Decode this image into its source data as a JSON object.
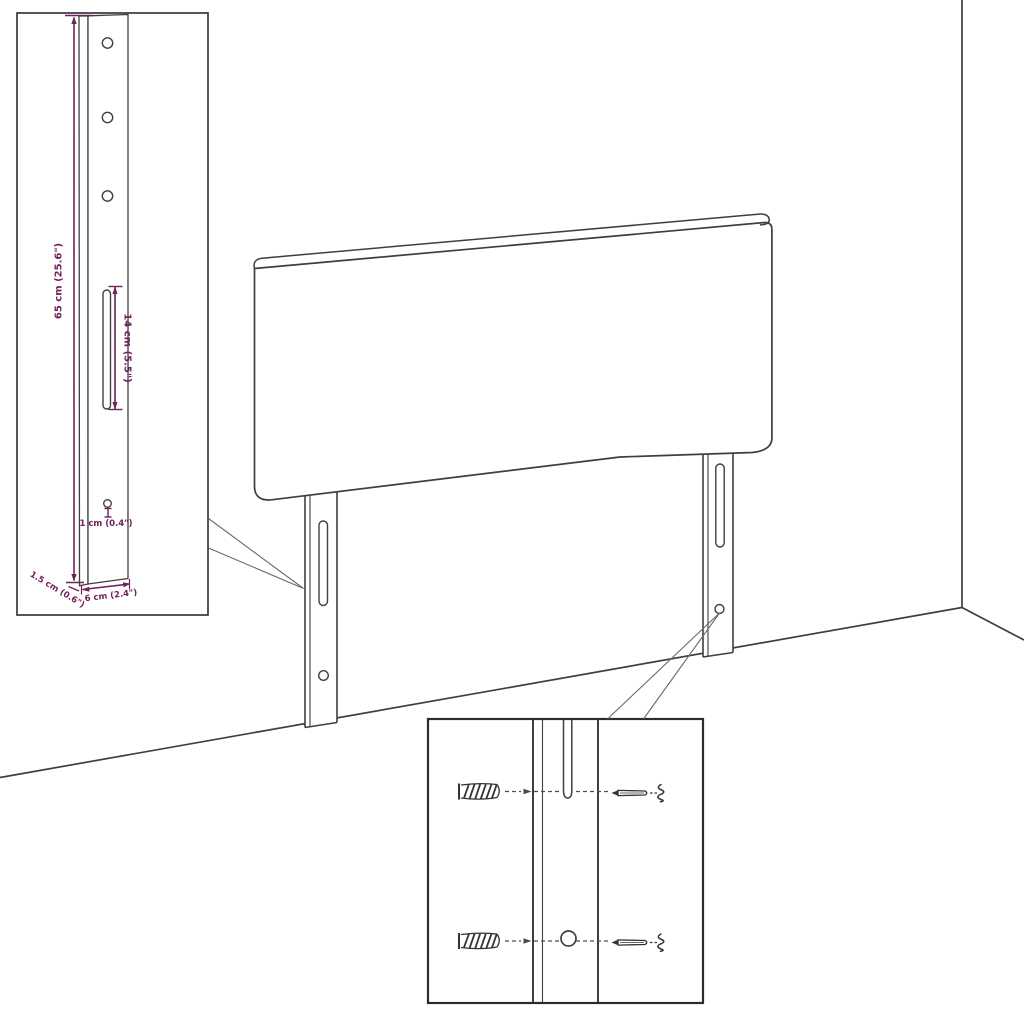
{
  "colors": {
    "background": "#ffffff",
    "line_art": "#3f3f3f",
    "dimension_accent": "#71215b",
    "callout_line": "#6a6a6a"
  },
  "bracket_inset": {
    "dim_height": "65 cm (25.6\")",
    "dim_slot": "14 cm (5.5\")",
    "dim_hole": "1 cm (0.4\")",
    "dim_thickness": "1.5 cm (0.6\")",
    "dim_width": "6 cm (2.4\")"
  },
  "icons": {
    "wall_plug": "wall-plug-icon",
    "screw": "screw-icon"
  }
}
